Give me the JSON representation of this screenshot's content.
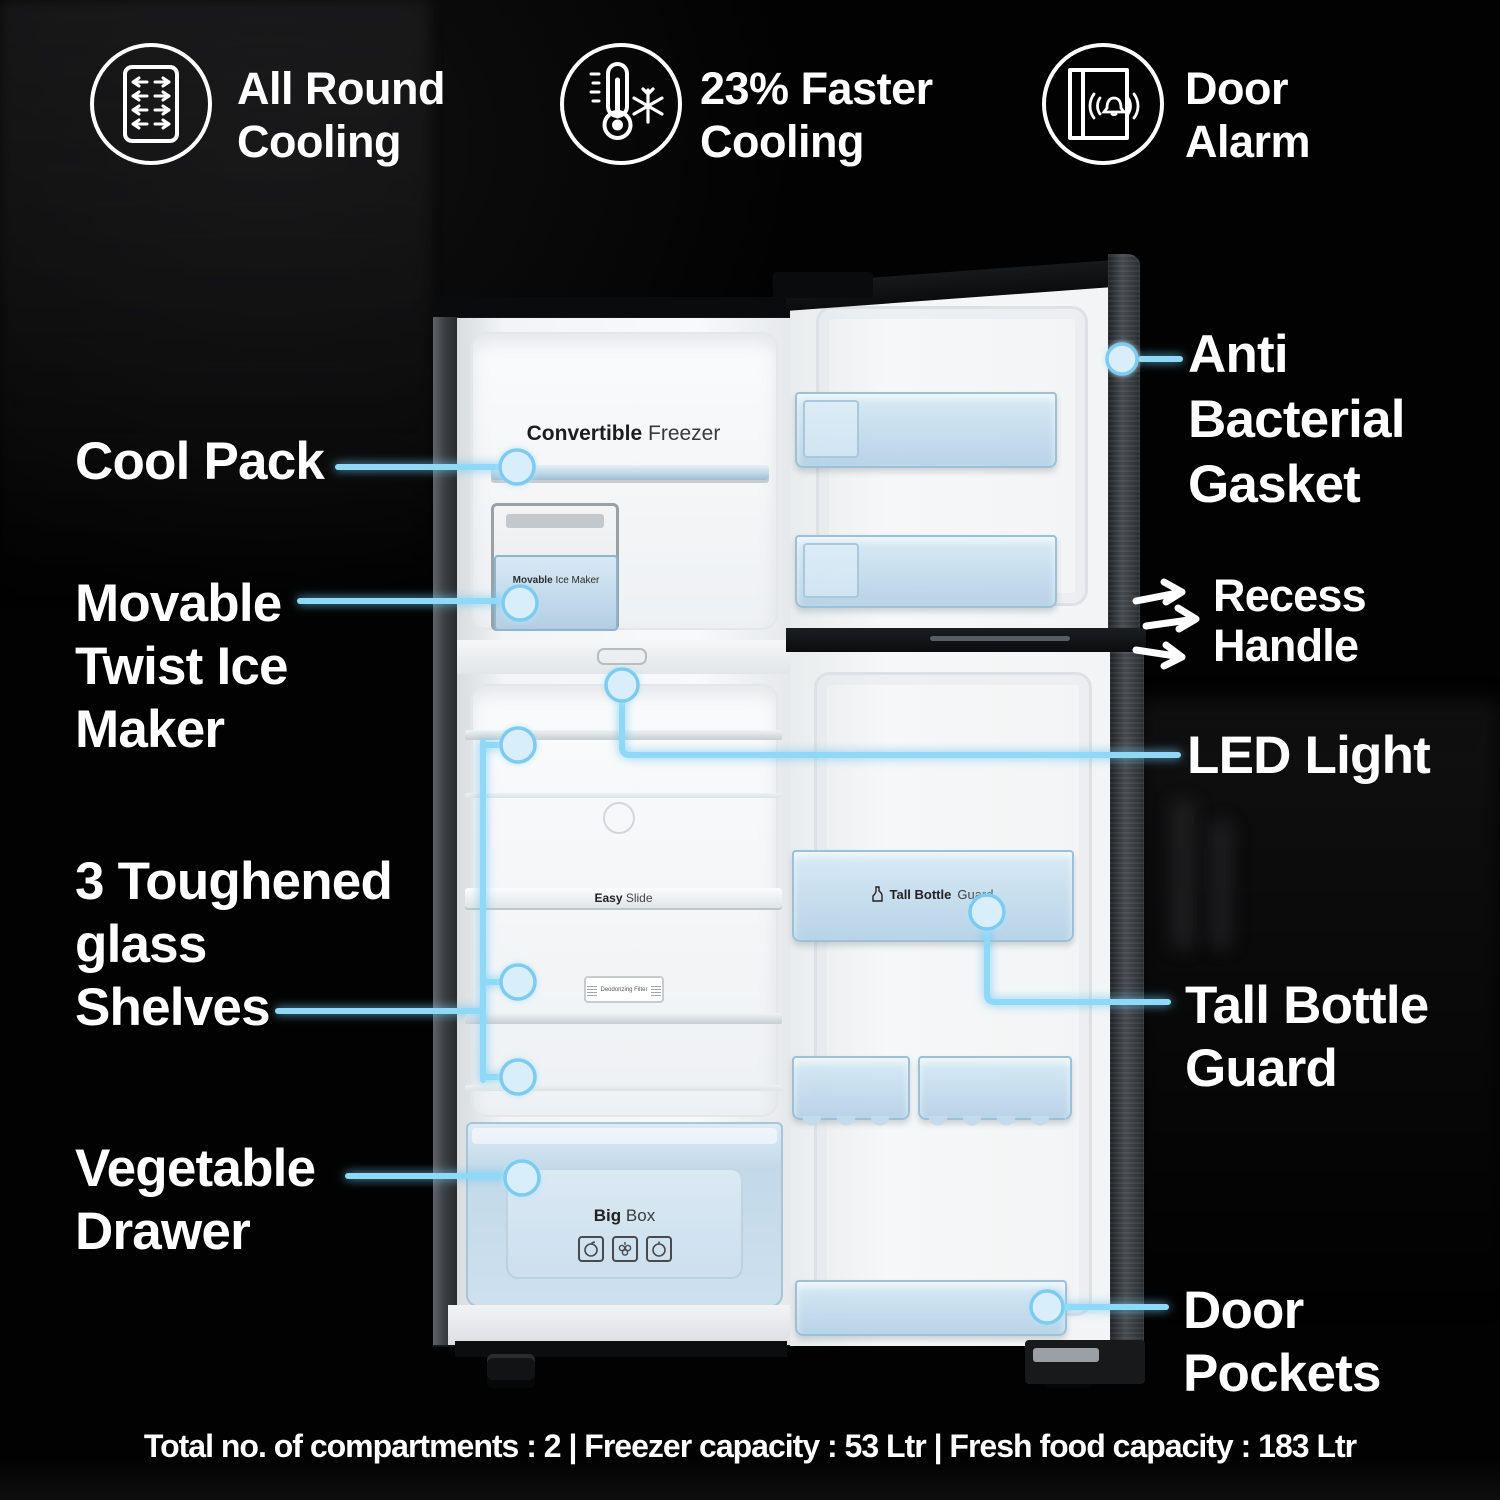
{
  "features": [
    {
      "icon": "all-round-cooling-icon",
      "line1": "All Round",
      "line2": "Cooling"
    },
    {
      "icon": "faster-cooling-icon",
      "line1": "23% Faster",
      "line2": "Cooling"
    },
    {
      "icon": "door-alarm-icon",
      "line1": "Door",
      "line2": "Alarm"
    }
  ],
  "callouts": {
    "cool_pack": [
      "Cool Pack"
    ],
    "ice_maker": [
      "Movable",
      "Twist Ice",
      "Maker"
    ],
    "shelves": [
      "3 Toughened",
      "glass",
      "Shelves"
    ],
    "vegetable": [
      "Vegetable",
      "Drawer"
    ],
    "gasket": [
      "Anti",
      "Bacterial",
      "Gasket"
    ],
    "recess": [
      "Recess",
      "Handle"
    ],
    "led": [
      "LED Light"
    ],
    "bottle_guard": [
      "Tall Bottle",
      "Guard"
    ],
    "pockets": [
      "Door",
      "Pockets"
    ]
  },
  "fridge": {
    "freezer_label": {
      "bold": "Convertible",
      "regular": "Freezer"
    },
    "ice_maker_label": {
      "bold": "Movable",
      "regular": "Ice Maker"
    },
    "shelf_label": {
      "bold": "Easy",
      "regular": "Slide"
    },
    "filter_label": "Deodorizing Filter",
    "bottle_guard_label": {
      "bold": "Tall Bottle",
      "regular": "Guard"
    },
    "drawer_label": {
      "bold": "Big",
      "regular": "Box"
    }
  },
  "footer": {
    "specs": "Total no. of compartments : 2 | Freezer capacity : 53 Ltr | Fresh food capacity : 183 Ltr"
  },
  "colors": {
    "background": "#020202",
    "label_text": "#ffffff",
    "accent_line": "#8ed9f7",
    "dot_fill": "#d8eefb",
    "dot_ring": "#7ecbef",
    "bin_blue": "#c3d9ea",
    "cabinet_dark": "#121416"
  }
}
